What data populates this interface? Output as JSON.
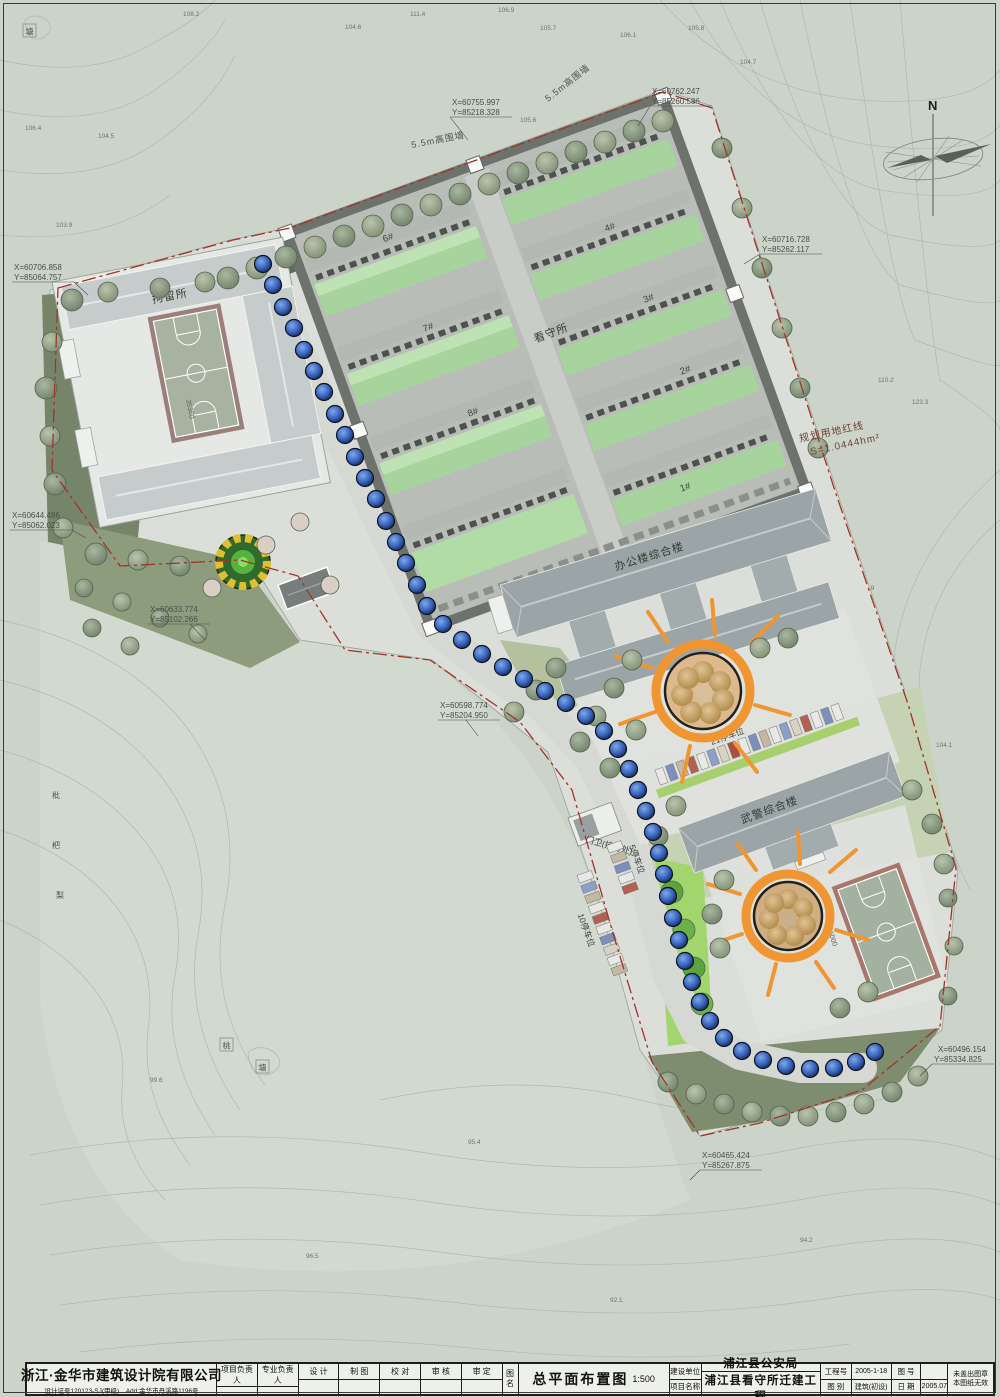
{
  "colors": {
    "accent_orange": "#ef9633",
    "red_line": "#a03528",
    "cellblock_green": "#a6d49c",
    "street_tree_blue": "#3f6fd0",
    "paper": "#ccd4ca"
  },
  "north": {
    "label": "N"
  },
  "site": {
    "prison_label": "看守所",
    "detention_label": "拘留所",
    "office_label": "办公楼综合楼",
    "police_label": "武警综合楼",
    "gate_label": "门卫(接待处)",
    "wall_label_top": "5.5m高围墙",
    "wall_label_left": "5.5m高围墙",
    "redline_label": "规划用地红线",
    "redline_area": "S=1.0444hm²",
    "parking_21": "21停车位",
    "parking_5": "5停车位",
    "parking_10": "10停车位",
    "dim_a": "35360",
    "dim_b": "6000",
    "dim_c": "6000",
    "building_numbers": [
      "1#",
      "2#",
      "3#",
      "4#",
      "5#",
      "6#",
      "7#",
      "8#"
    ],
    "misc_labels": [
      {
        "t": "塘"
      },
      {
        "t": "桃"
      },
      {
        "t": "塘"
      },
      {
        "t": "枇"
      },
      {
        "t": "杷"
      },
      {
        "t": "梨"
      }
    ]
  },
  "coordinates": [
    {
      "x": "X=60762.247",
      "y": "Y=85260.586"
    },
    {
      "x": "X=60755.997",
      "y": "Y=85218.328"
    },
    {
      "x": "X=60716.728",
      "y": "Y=85262.117"
    },
    {
      "x": "X=60706.858",
      "y": "Y=85064.757"
    },
    {
      "x": "X=60644.486",
      "y": "Y=85062.023"
    },
    {
      "x": "X=60633.774",
      "y": "Y=85102.266"
    },
    {
      "x": "X=60598.774",
      "y": "Y=85204.950"
    },
    {
      "x": "X=60496.154",
      "y": "Y=85334.825"
    },
    {
      "x": "X=60465.424",
      "y": "Y=85267.875"
    }
  ],
  "spot_elevations": [
    {
      "v": "108.2"
    },
    {
      "v": "111.4"
    },
    {
      "v": "104.6"
    },
    {
      "v": "106.9"
    },
    {
      "v": "105.7"
    },
    {
      "v": "106.1"
    },
    {
      "v": "105.8"
    },
    {
      "v": "104.7"
    },
    {
      "v": "105.6"
    },
    {
      "v": "103.3"
    },
    {
      "v": "105.9"
    },
    {
      "v": "110.2"
    },
    {
      "v": "123.3"
    },
    {
      "v": "106.9"
    },
    {
      "v": "104.1"
    },
    {
      "v": "98.3"
    },
    {
      "v": "106.4"
    },
    {
      "v": "104.5"
    },
    {
      "v": "103.9"
    },
    {
      "v": "95.4"
    },
    {
      "v": "96.5"
    },
    {
      "v": "92.1"
    },
    {
      "v": "94.2"
    },
    {
      "v": "99.6"
    }
  ],
  "titleblock": {
    "company": "浙江·金华市建筑设计院有限公司",
    "company_sub": "设计证号120123-SJ(甲级)　Add:金华市丹溪路1196号",
    "cols": [
      "项目负责人",
      "专业负责人",
      "设 计",
      "制 图",
      "校 对",
      "审 核",
      "审 定"
    ],
    "tuming_l1": "图",
    "tuming_l2": "名",
    "drawing_title": "总平面布置图",
    "drawing_scale": "1:500",
    "jsdw_label": "建设单位",
    "jsdw": "浦江县公安局",
    "xmmc_label": "项目名称",
    "xmmc": "浦江县看守所迁建工程",
    "gch_label": "工程号",
    "gch": "2005-1-18",
    "th_label": "图 号",
    "th": "",
    "tb_label": "图 别",
    "tb": "建筑(初设)",
    "rq_label": "日 期",
    "rq": "2005.07",
    "note1": "未盖出图章",
    "note2": "本图纸无效"
  }
}
